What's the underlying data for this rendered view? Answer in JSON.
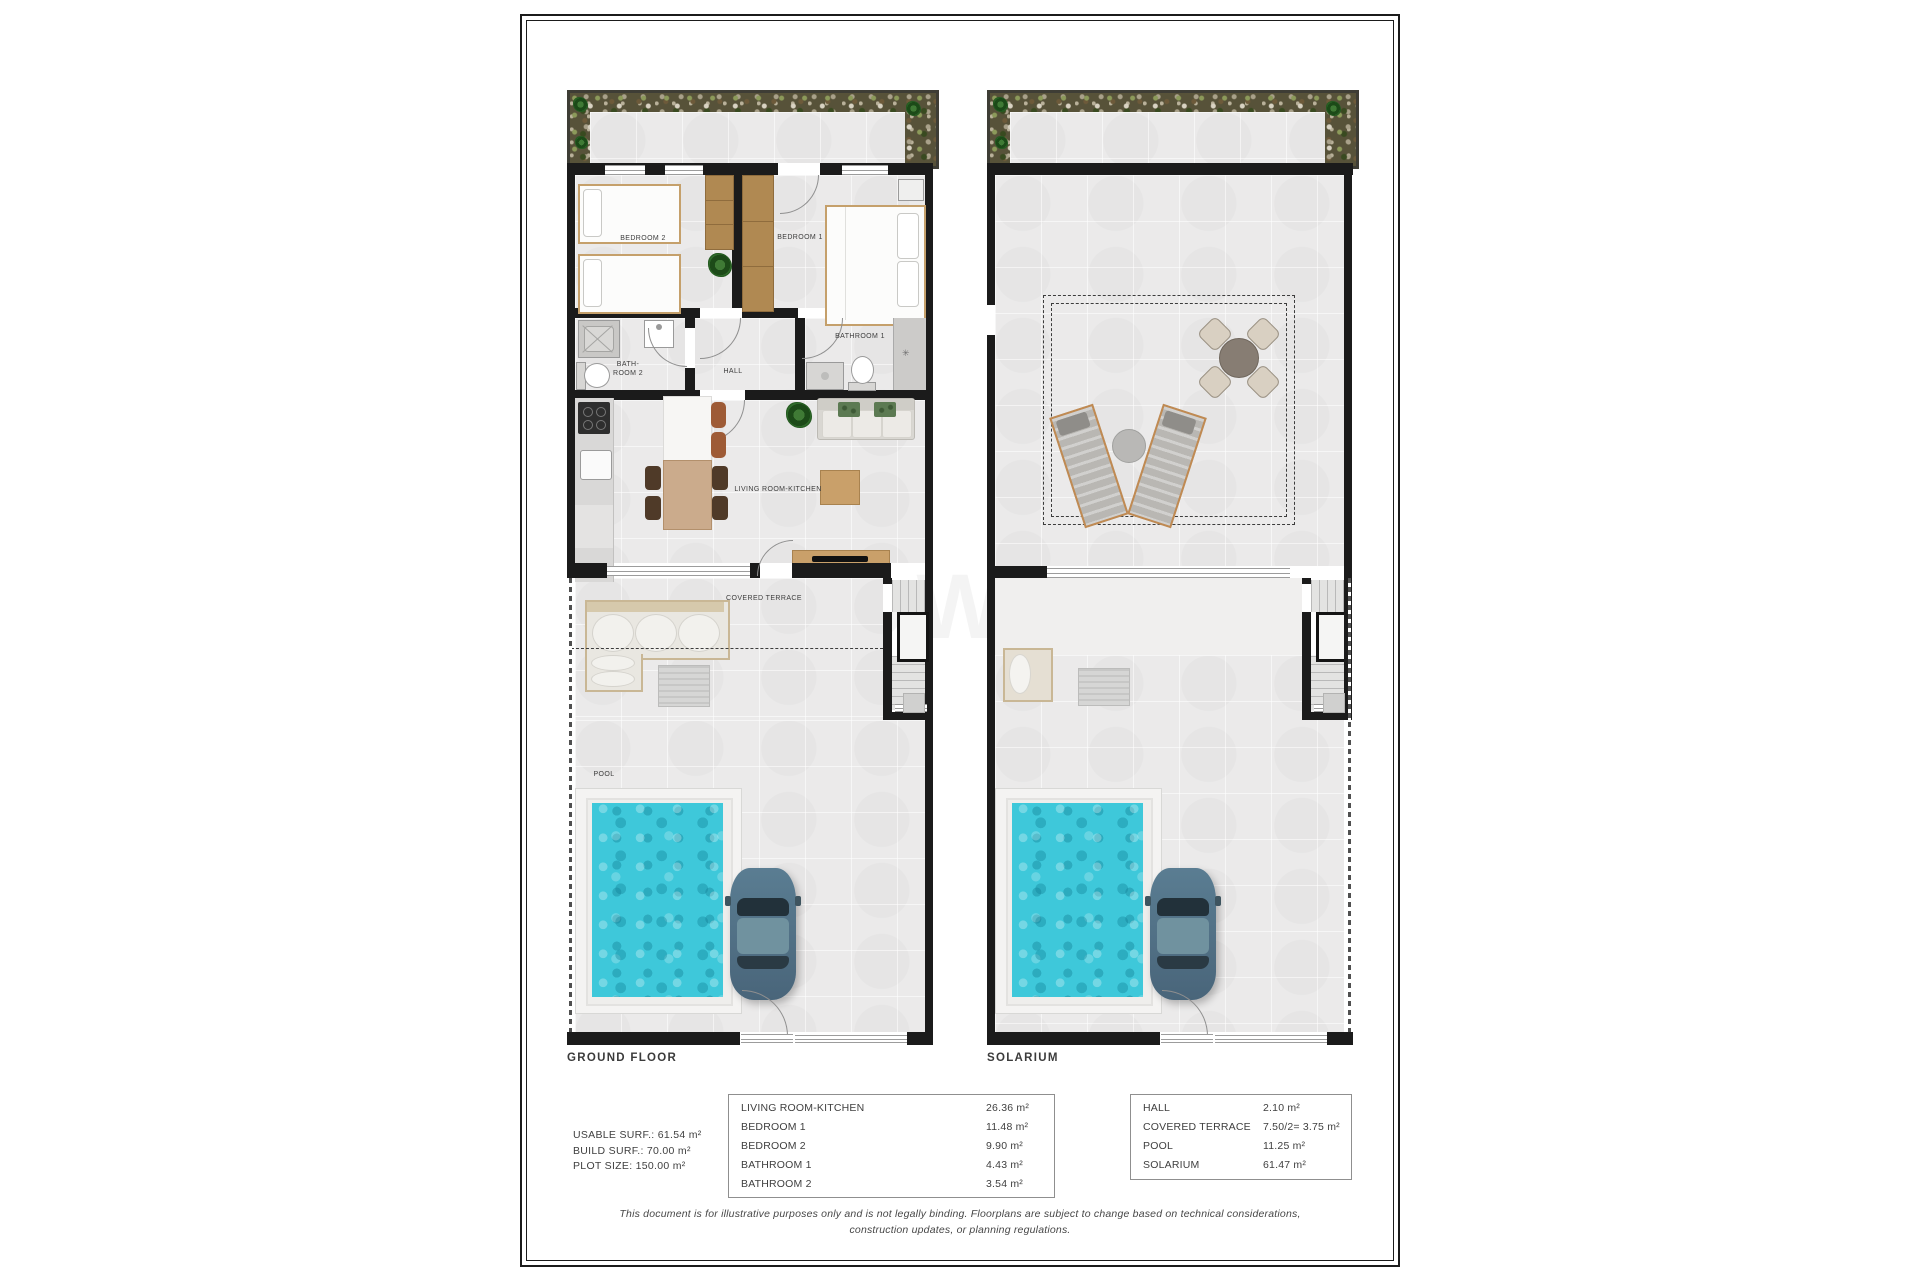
{
  "titles": {
    "ground_floor": "GROUND FLOOR",
    "solarium": "SOLARIUM"
  },
  "room_labels": {
    "bedroom1": "BEDROOM 1",
    "bedroom2": "BEDROOM 2",
    "bathroom1": "BATHROOM 1",
    "bathroom2_line1": "BATH-",
    "bathroom2_line2": "ROOM 2",
    "hall": "HALL",
    "living_room": "LIVING ROOM-KITCHEN",
    "covered_terrace": "COVERED TERRACE",
    "pool": "POOL"
  },
  "stats": {
    "usable": "USABLE SURF.: 61.54 m²",
    "build": "BUILD SURF.: 70.00 m²",
    "plot": "PLOT SIZE: 150.00 m²"
  },
  "area_table_interior": {
    "rows": [
      {
        "label": "LIVING ROOM-KITCHEN",
        "value": "26.36 m²"
      },
      {
        "label": "BEDROOM 1",
        "value": "11.48 m²"
      },
      {
        "label": "BEDROOM 2",
        "value": "9.90 m²"
      },
      {
        "label": "BATHROOM 1",
        "value": "4.43 m²"
      },
      {
        "label": "BATHROOM 2",
        "value": "3.54 m²"
      }
    ]
  },
  "area_table_exterior": {
    "rows": [
      {
        "label": "HALL",
        "value": "2.10 m²"
      },
      {
        "label": "COVERED TERRACE",
        "value": "7.50/2= 3.75 m²"
      },
      {
        "label": "POOL",
        "value": "11.25 m²"
      },
      {
        "label": "SOLARIUM",
        "value": "61.47 m²"
      }
    ]
  },
  "disclaimer": {
    "line1": "This document is for illustrative purposes only and is not legally binding. Floorplans are subject to change based on technical considerations,",
    "line2": "construction updates, or planning regulations."
  },
  "watermark": "OWEN",
  "colors": {
    "pool_water": "#3ec8da",
    "wall": "#1b1b1b",
    "wood": "#b08952"
  }
}
